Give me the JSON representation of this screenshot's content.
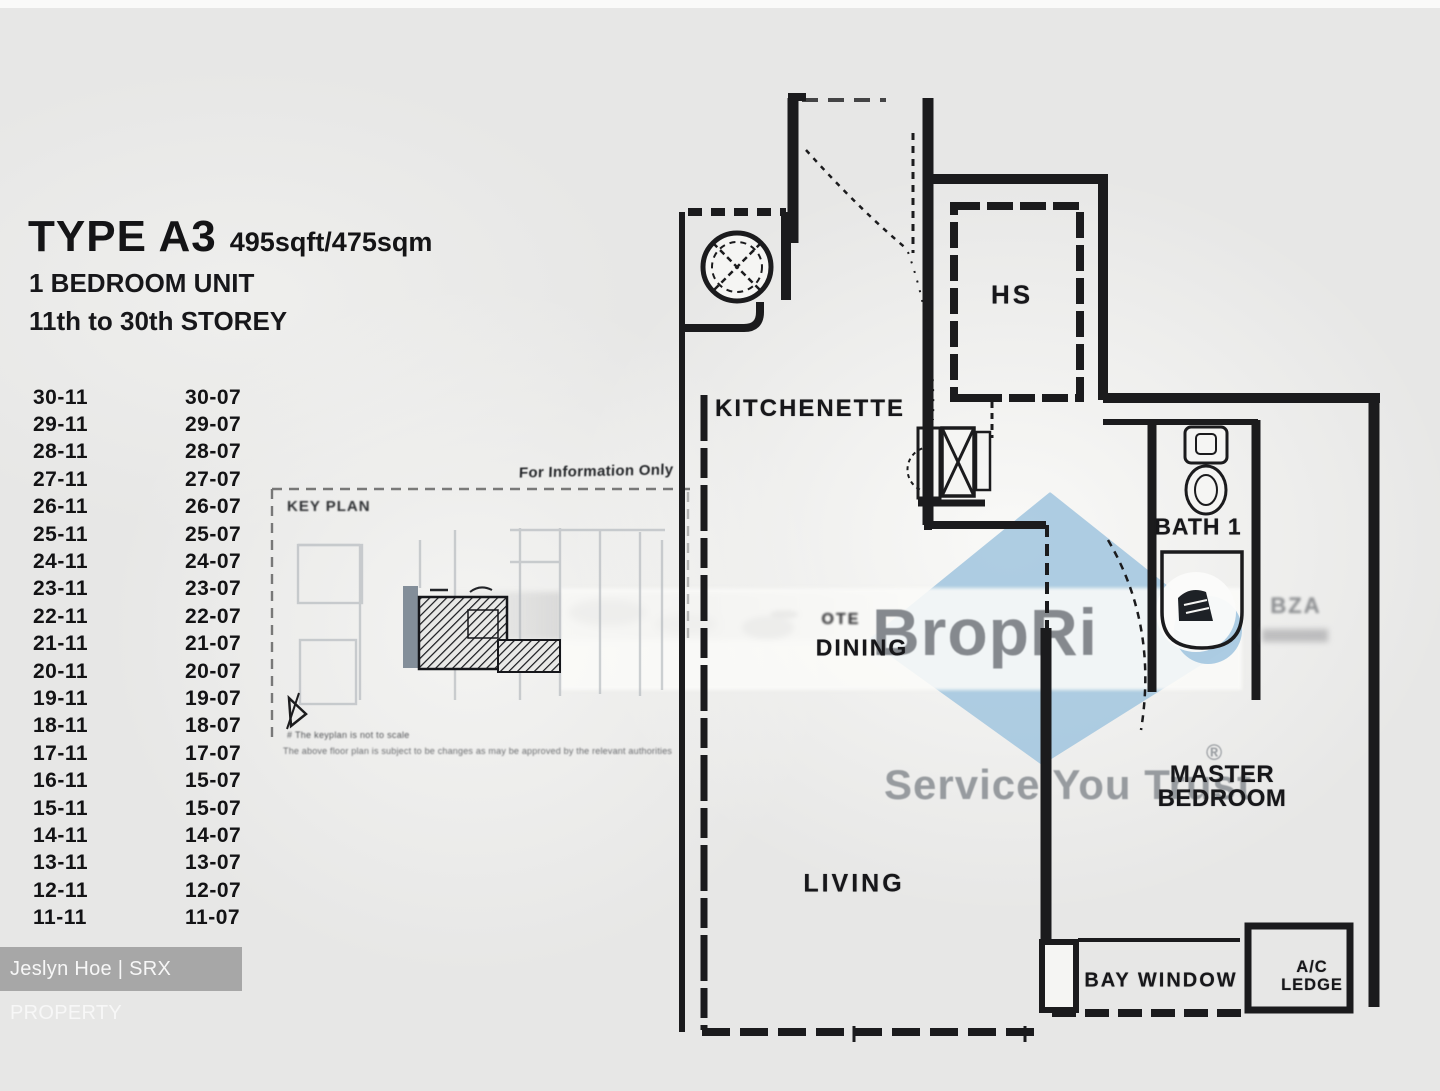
{
  "header": {
    "type_label": "TYPE A3",
    "area_label": "495sqft/475sqm",
    "unit_type": "1 BEDROOM UNIT",
    "storey_range": "11th to 30th STOREY"
  },
  "stack_list": {
    "rows": [
      {
        "left": "30-11",
        "right": "30-07"
      },
      {
        "left": "29-11",
        "right": "29-07"
      },
      {
        "left": "28-11",
        "right": "28-07"
      },
      {
        "left": "27-11",
        "right": "27-07"
      },
      {
        "left": "26-11",
        "right": "26-07"
      },
      {
        "left": "25-11",
        "right": "25-07"
      },
      {
        "left": "24-11",
        "right": "24-07"
      },
      {
        "left": "23-11",
        "right": "23-07"
      },
      {
        "left": "22-11",
        "right": "22-07"
      },
      {
        "left": "21-11",
        "right": "21-07"
      },
      {
        "left": "20-11",
        "right": "20-07"
      },
      {
        "left": "19-11",
        "right": "19-07"
      },
      {
        "left": "18-11",
        "right": "18-07"
      },
      {
        "left": "17-11",
        "right": "17-07"
      },
      {
        "left": "16-11",
        "right": "15-07"
      },
      {
        "left": "15-11",
        "right": "15-07"
      },
      {
        "left": "14-11",
        "right": "14-07"
      },
      {
        "left": "13-11",
        "right": "13-07"
      },
      {
        "left": "12-11",
        "right": "12-07"
      },
      {
        "left": "11-11",
        "right": "11-07"
      }
    ]
  },
  "key_plan": {
    "title": "KEY PLAN",
    "info_note": "For Information Only",
    "disclaimer_line1": "# The keyplan is not to scale",
    "disclaimer_line2": "The above floor plan is subject to be changes as may be approved by the relevant authorities"
  },
  "floor_plan": {
    "rooms": {
      "kitchenette": "KITCHENETTE",
      "household_shelter": "HS",
      "bath1": "BATH 1",
      "dining": "DINING",
      "dining_ghost": "OTE",
      "master_line1": "MASTER",
      "master_line2": "BEDROOM",
      "living": "LIVING",
      "bay_window": "BAY WINDOW",
      "ac_ledge_line1": "A/C",
      "ac_ledge_line2": "LEDGE",
      "ghost_text": "BZA"
    }
  },
  "watermark": {
    "logo_text": "BropRi",
    "tagline": "Service You Trust",
    "registered_mark": "®",
    "diamond_color": "#a3c6e0",
    "text_color": "#85898e",
    "tagline_color": "#979b9f"
  },
  "footer_badge": {
    "text": "Jeslyn Hoe | SRX PROPERTY",
    "background": "#a7a7a7"
  }
}
